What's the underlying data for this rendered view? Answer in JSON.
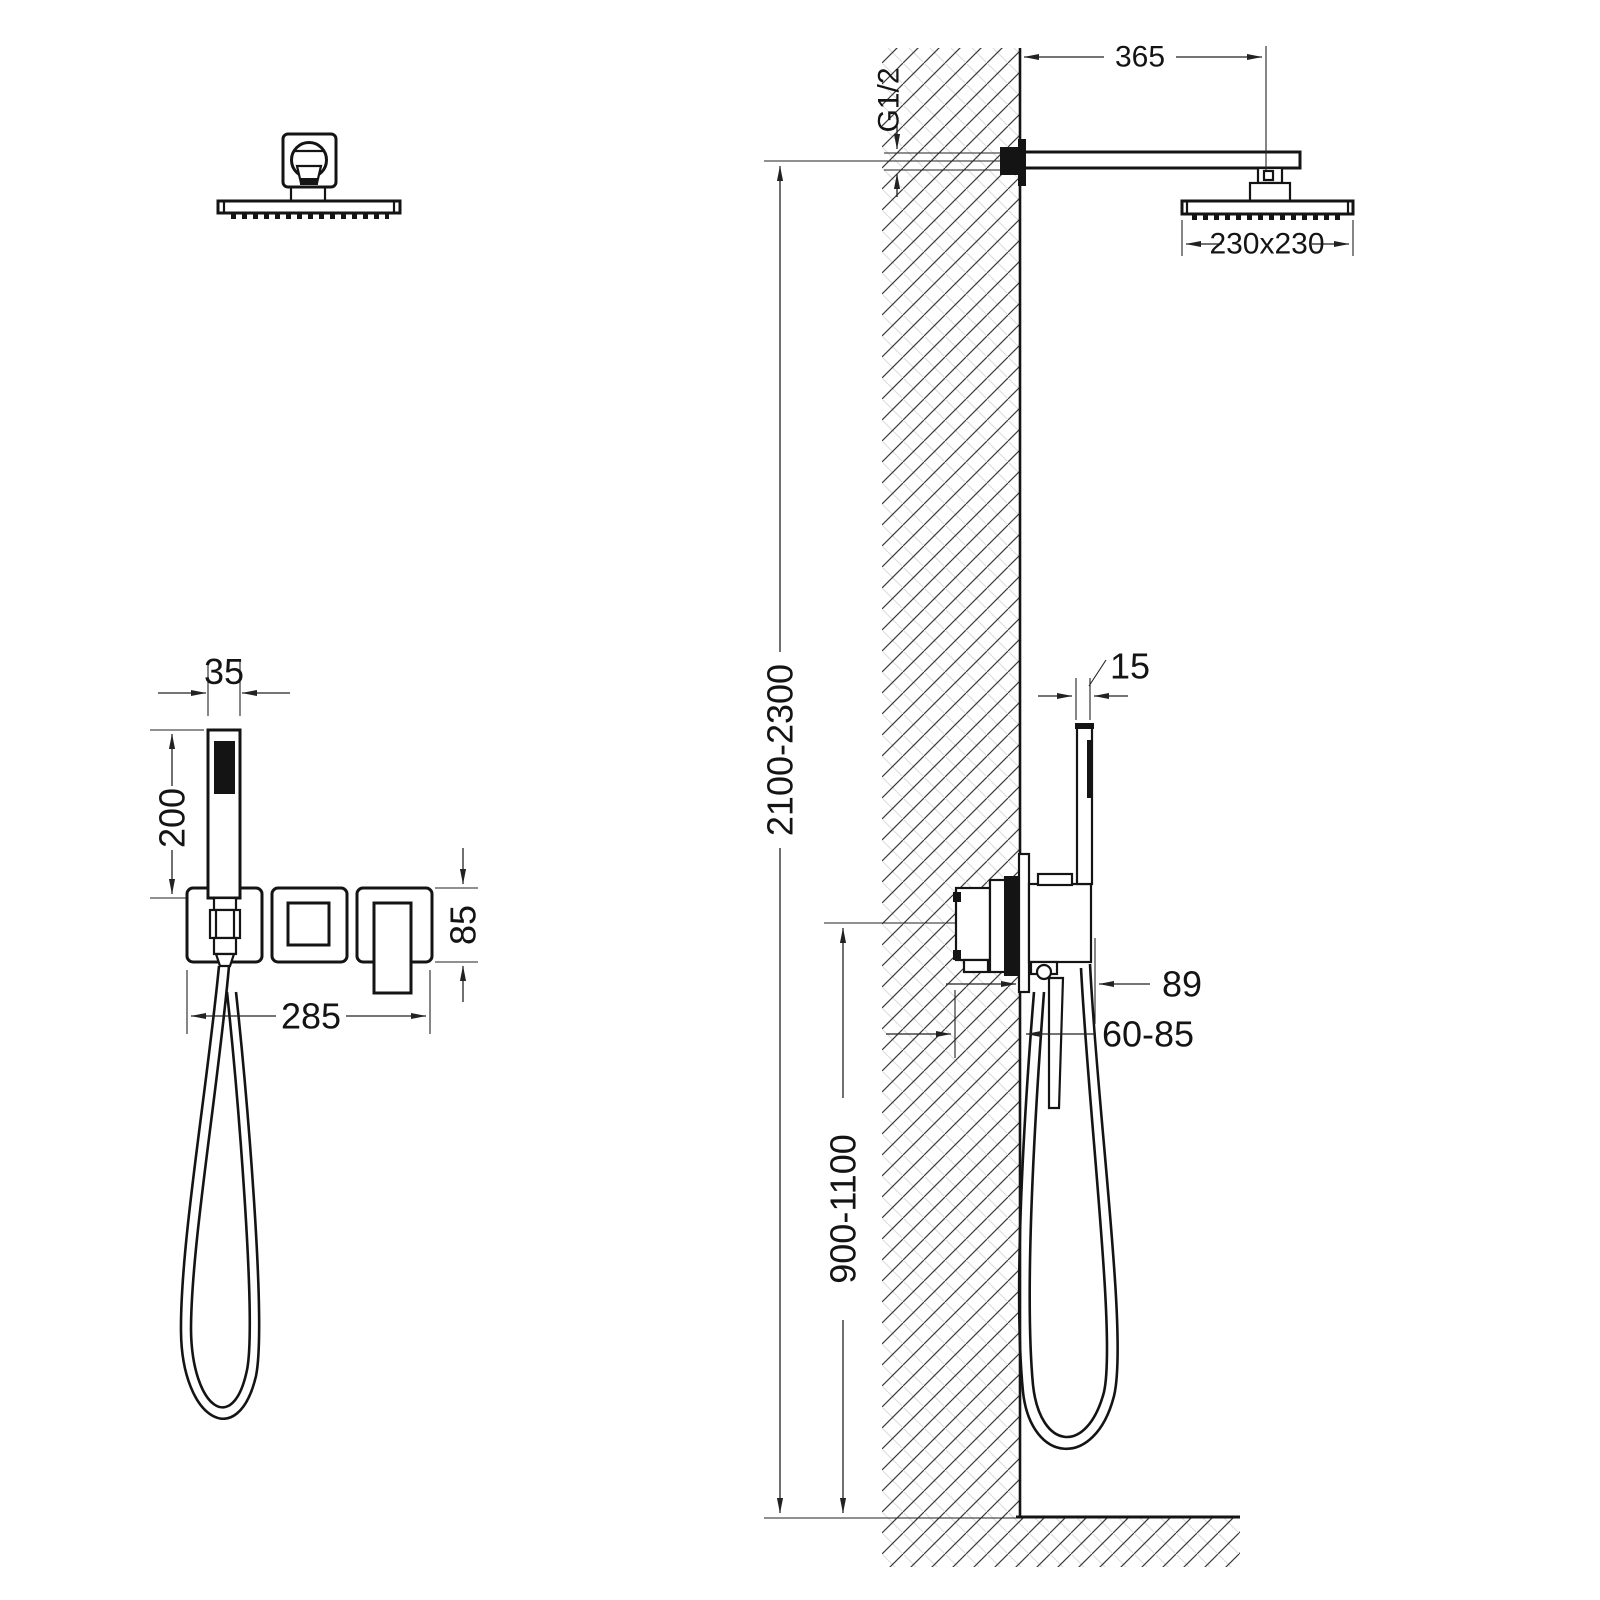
{
  "drawing": {
    "kind": "shower system installation dimension drawing",
    "ink_color": "#141414",
    "hatch_dark_color": "#3a3a3a",
    "hatch_light_color": "#d9d9d9",
    "front_view": {
      "dims": {
        "hand_shower_width": "35",
        "hand_shower_length": "200",
        "trim_plates_width": "285",
        "trim_plate_height": "85"
      }
    },
    "side_view": {
      "dims": {
        "arm_length": "365",
        "thread": "G1/2",
        "head_size": "230x230",
        "hand_shower_depth": "15",
        "install_height": "2100-2300",
        "valve_height": "900-1100",
        "projection": "89",
        "embed_depth": "60-85"
      }
    }
  }
}
